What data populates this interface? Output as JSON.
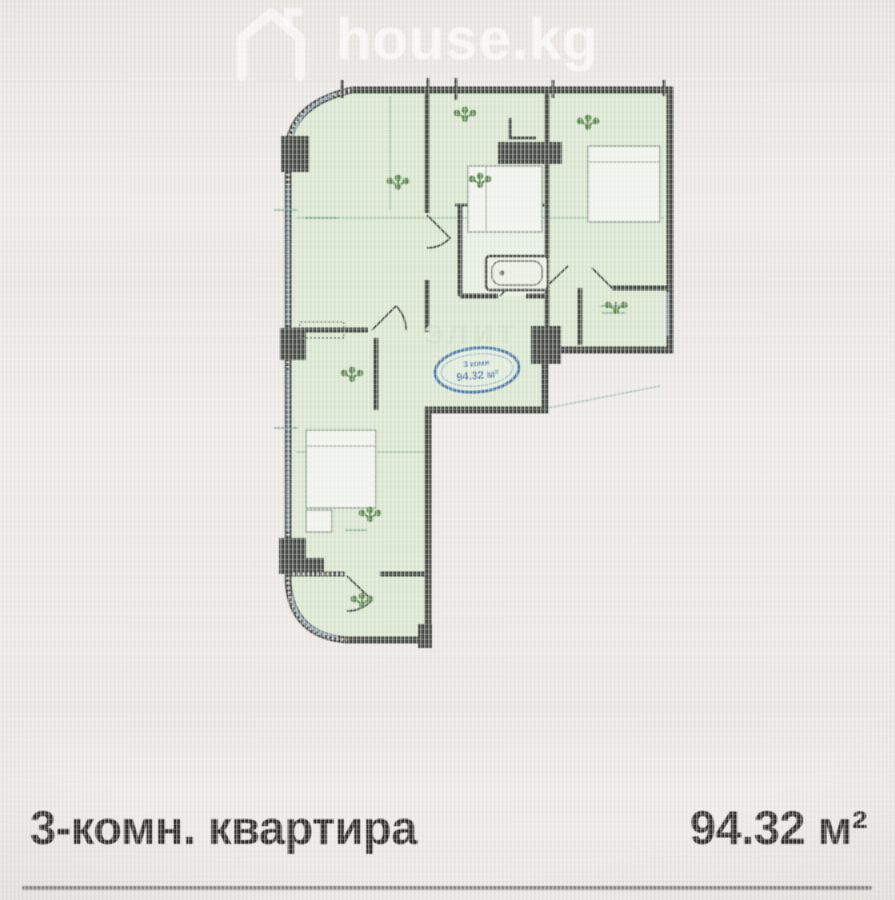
{
  "watermark": {
    "brand": "house.kg"
  },
  "plan": {
    "stamp": {
      "line1": "3 комн",
      "line2": "94.32 м²"
    },
    "watermark_text": "элит",
    "colors": {
      "room_fill": "#d8e7ce",
      "wall": "#464b43",
      "window": "#8aa7bc",
      "stamp_blue": "#4a7cad",
      "fixture_green": "#5c8a4e",
      "background": "#e9e6e2"
    }
  },
  "caption": {
    "rooms_label": "3-комн. квартира",
    "area_label": "94.32 м²"
  }
}
